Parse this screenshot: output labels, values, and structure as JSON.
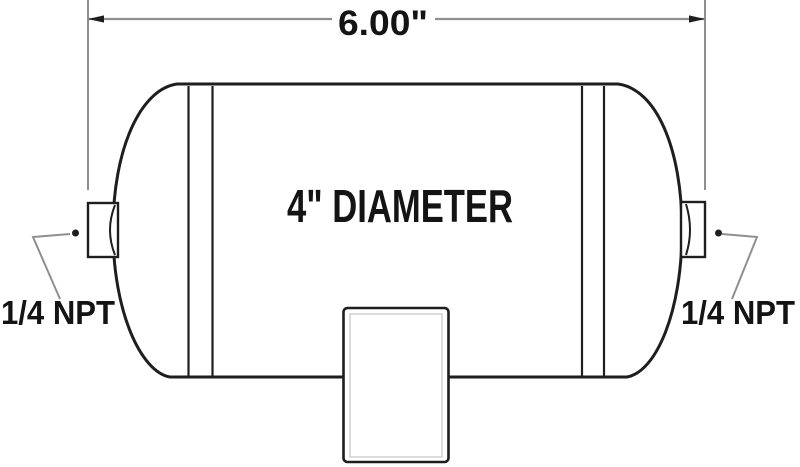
{
  "drawing": {
    "title": "air-tank-dimension-drawing",
    "background_color": "#ffffff",
    "outline_color": "#1e1e1e",
    "dimension_line_color": "#8f8f8f",
    "text_color": "#141414",
    "length_dimension": {
      "label": "6.00\""
    },
    "diameter_label": "4\" DIAMETER",
    "left_port": {
      "label": "1/4 NPT"
    },
    "right_port": {
      "label": "1/4 NPT"
    }
  }
}
